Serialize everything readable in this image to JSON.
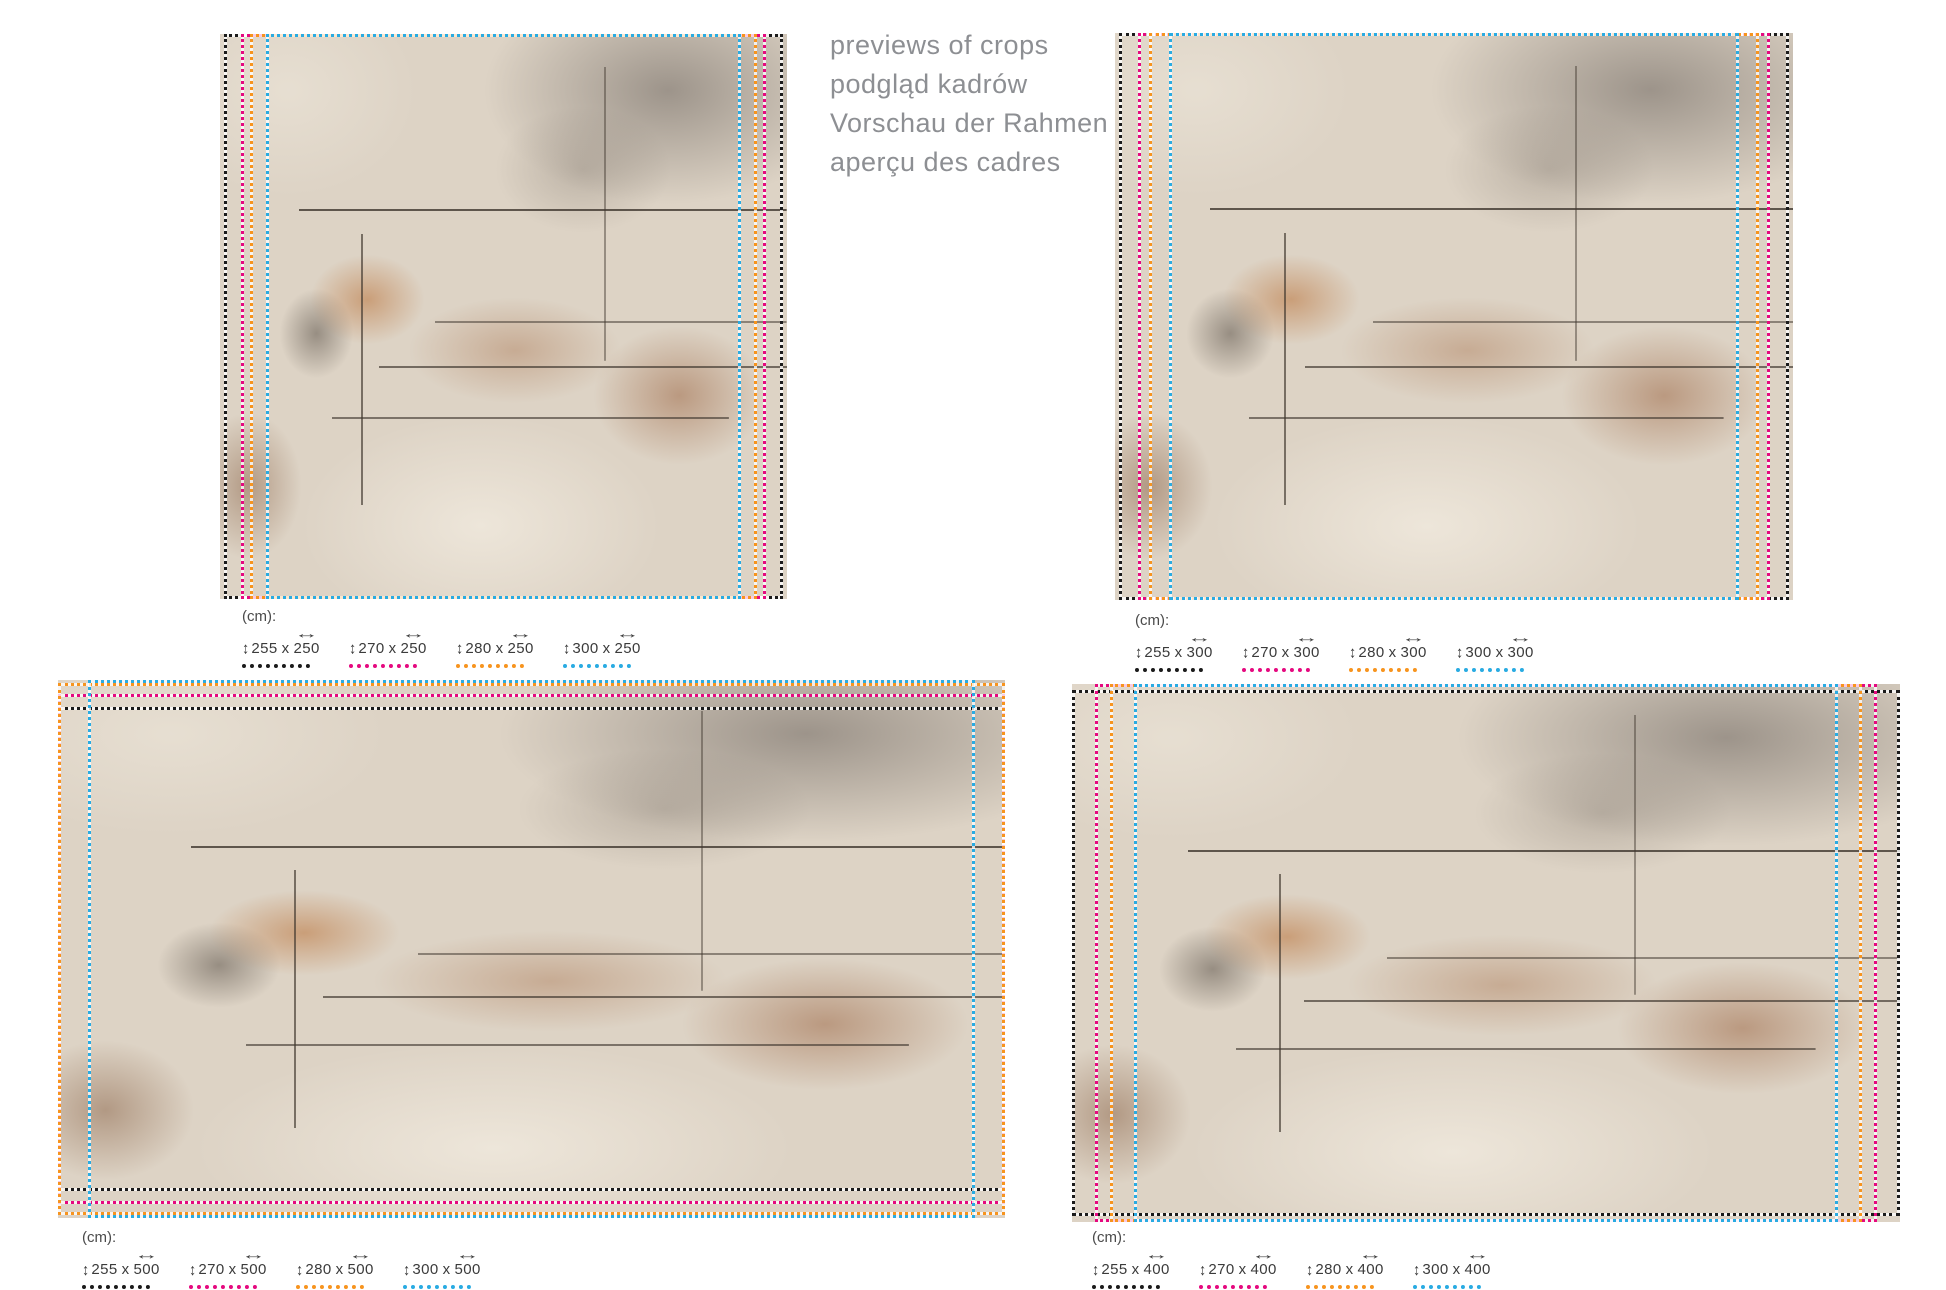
{
  "header": {
    "lines": [
      "previews of crops",
      "podgląd kadrów",
      "Vorschau der Rahmen",
      "aperçu des cadres"
    ]
  },
  "unit_label": "(cm):",
  "separator": "x",
  "icons": {
    "height_arrows": "↕",
    "width_arrows": "↔"
  },
  "frame_colors": {
    "black": "#1b1b1b",
    "pink": "#e5097f",
    "orange": "#f7941e",
    "blue": "#29abe2"
  },
  "panels": [
    {
      "position": "top-left",
      "sizes": [
        {
          "h": "255",
          "w": "250",
          "color": "black"
        },
        {
          "h": "270",
          "w": "250",
          "color": "pink"
        },
        {
          "h": "280",
          "w": "250",
          "color": "orange"
        },
        {
          "h": "300",
          "w": "250",
          "color": "blue"
        }
      ]
    },
    {
      "position": "top-right",
      "sizes": [
        {
          "h": "255",
          "w": "300",
          "color": "black"
        },
        {
          "h": "270",
          "w": "300",
          "color": "pink"
        },
        {
          "h": "280",
          "w": "300",
          "color": "orange"
        },
        {
          "h": "300",
          "w": "300",
          "color": "blue"
        }
      ]
    },
    {
      "position": "bottom-left",
      "sizes": [
        {
          "h": "255",
          "w": "500",
          "color": "black"
        },
        {
          "h": "270",
          "w": "500",
          "color": "pink"
        },
        {
          "h": "280",
          "w": "500",
          "color": "orange"
        },
        {
          "h": "300",
          "w": "500",
          "color": "blue"
        }
      ]
    },
    {
      "position": "bottom-right",
      "sizes": [
        {
          "h": "255",
          "w": "400",
          "color": "black"
        },
        {
          "h": "270",
          "w": "400",
          "color": "pink"
        },
        {
          "h": "280",
          "w": "400",
          "color": "orange"
        },
        {
          "h": "300",
          "w": "400",
          "color": "blue"
        }
      ]
    }
  ]
}
